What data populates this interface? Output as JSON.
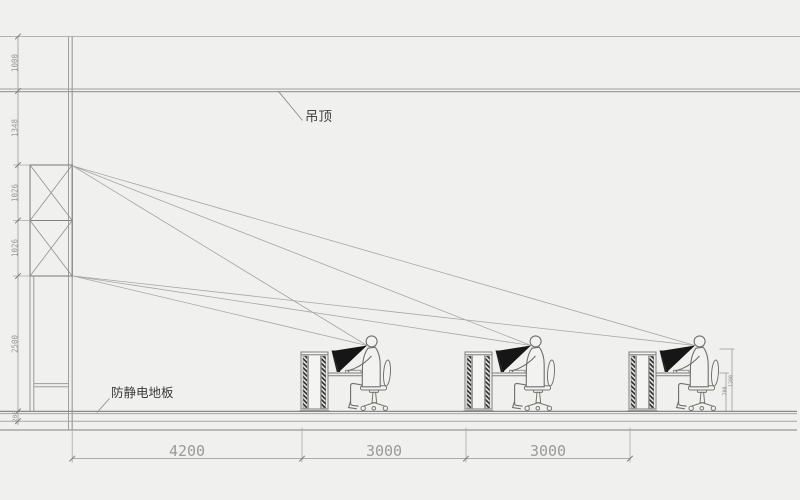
{
  "labels": {
    "ceiling": "吊顶",
    "floor": "防静电地板"
  },
  "dimensions": {
    "left": [
      "1000",
      "1348",
      "1026",
      "1026",
      "2500",
      "200"
    ],
    "bottom": [
      "4200",
      "3000",
      "3000"
    ],
    "right": [
      "1200",
      "700"
    ]
  },
  "colors": {
    "background": "#f0f0ee",
    "line": "#9e9e9c",
    "line_dark": "#7d7d7b",
    "figure": "#6f6f6d",
    "view_cone": "#161616",
    "dim_text": "#9a9a98",
    "label_text": "#454543"
  }
}
